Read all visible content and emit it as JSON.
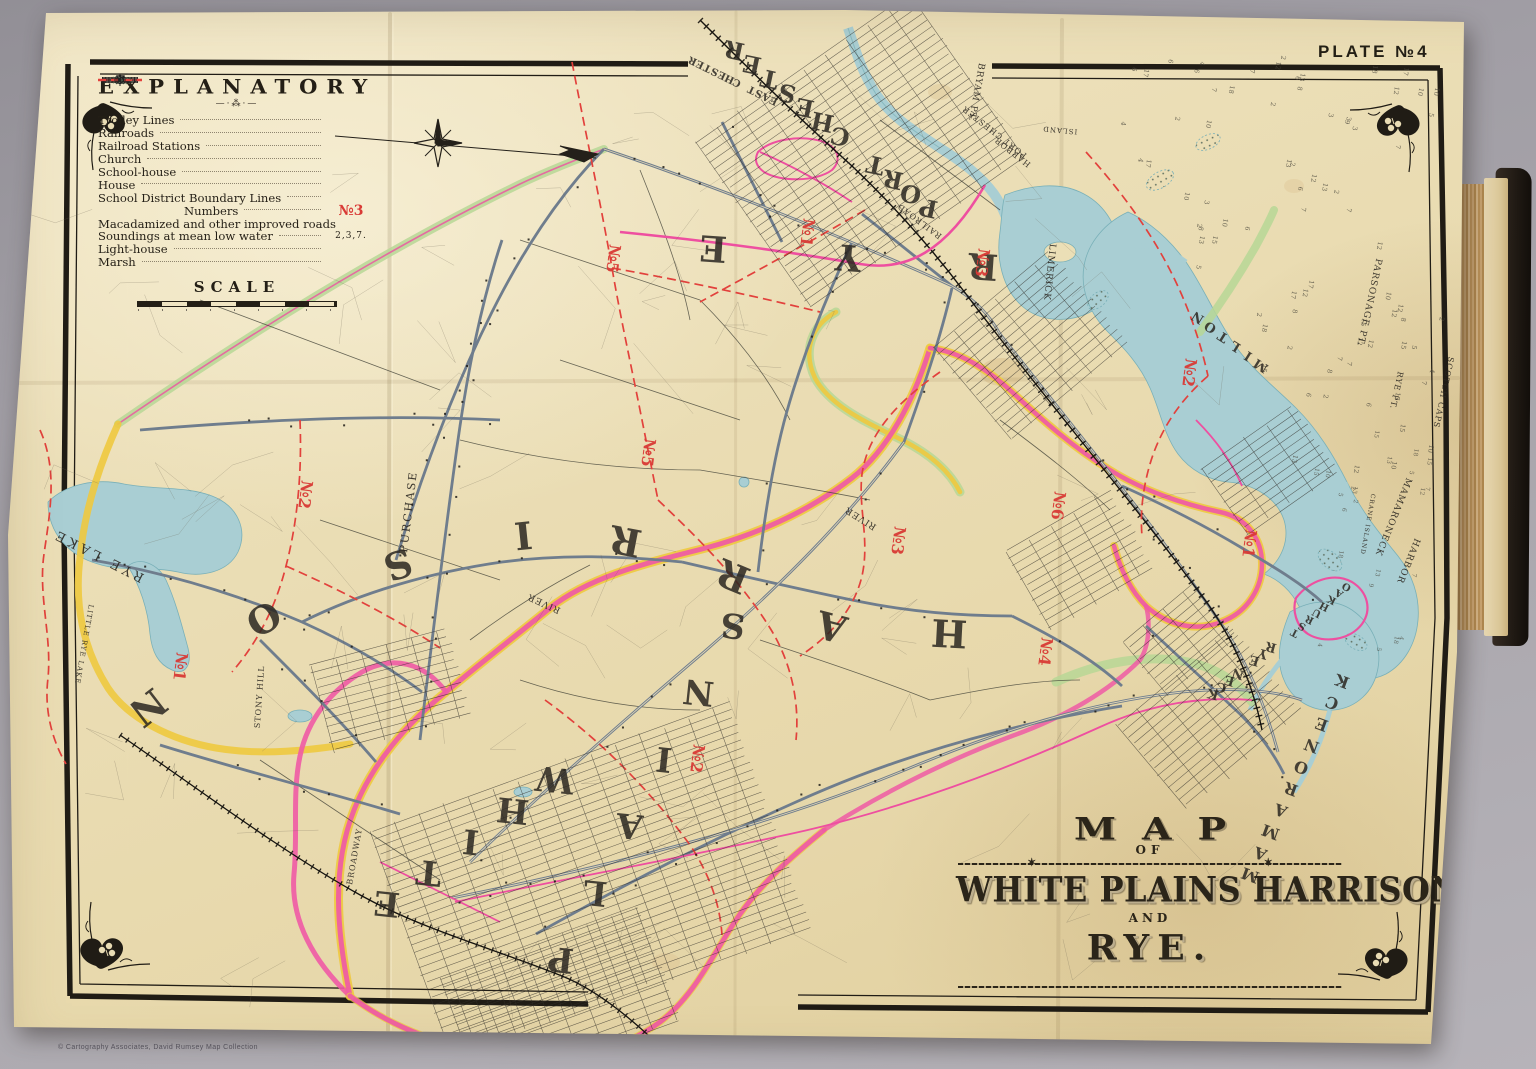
{
  "plate_label": "PLATE №4",
  "credit": "© Cartography Associates, David Rumsey Map Collection",
  "legend": {
    "title": "EXPLANATORY",
    "items": [
      {
        "label": "Trolley Lines",
        "symbol": "trolley-line"
      },
      {
        "label": "Railroads",
        "symbol": "railroad-line"
      },
      {
        "label": "Railroad Stations",
        "symbol": "station-square"
      },
      {
        "label": "Church",
        "symbol": "church-cross"
      },
      {
        "label": "School-house",
        "symbol": "school-rect"
      },
      {
        "label": "House",
        "symbol": "house-dot"
      },
      {
        "label": "School District Boundary Lines",
        "symbol": "red-dashes"
      },
      {
        "label": "Numbers",
        "symbol": "district-number",
        "symbol_text": "№3",
        "indent": true
      },
      {
        "label": "Macadamized and other improved roads",
        "symbol": "macadam-line"
      },
      {
        "label": "Soundings at mean low water",
        "symbol": "soundings-text",
        "symbol_text": "2,3,7."
      },
      {
        "label": "Light-house",
        "symbol": "lighthouse-star"
      },
      {
        "label": "Marsh",
        "symbol": "marsh-glyph"
      }
    ],
    "scale_title": "SCALE"
  },
  "title_cartouche": {
    "line1": "MAP",
    "line2": "OF",
    "line3": "WHITE PLAINS HARRISON",
    "line4": "AND",
    "line5": "RYE."
  },
  "map": {
    "colors": {
      "paper": "#ebdfb6",
      "ink": "#2b2721",
      "water": "#a9ced3",
      "boundary_pink": "#ef5aa5",
      "boundary_yellow": "#eec93f",
      "boundary_green": "#b7d795",
      "district_red": "#d93a35",
      "trolley_pink": "#ee4fa0"
    },
    "towns_large": [
      {
        "text": "RYE",
        "x1": 984,
        "y1": 254,
        "x2": 714,
        "y2": 236,
        "size": 36,
        "rot": 184
      },
      {
        "text": "PORT CHESTER",
        "x1": 930,
        "y1": 200,
        "x2": 736,
        "y2": 42,
        "size": 24,
        "rot": 192
      },
      {
        "text": "EAST CHESTER",
        "x1": 775,
        "y1": 98,
        "x2": 694,
        "y2": 58,
        "size": 10,
        "rot": 205
      },
      {
        "text": "WHITE",
        "x1": 556,
        "y1": 768,
        "x2": 388,
        "y2": 892,
        "size": 34,
        "rot": 186
      },
      {
        "text": "PLAINS",
        "x1": 562,
        "y1": 948,
        "x2": 734,
        "y2": 614,
        "size": 34,
        "rot": 186
      },
      {
        "text": "MAMARONECK",
        "x1": 1252,
        "y1": 870,
        "x2": 1344,
        "y2": 676,
        "size": 16,
        "rot": 200
      },
      {
        "text": "RYE NECK",
        "x1": 1272,
        "y1": 643,
        "x2": 1214,
        "y2": 690,
        "size": 13,
        "rot": 195
      },
      {
        "text": "OAKHURST",
        "x1": 1348,
        "y1": 584,
        "x2": 1296,
        "y2": 630,
        "size": 10,
        "rot": 207
      },
      {
        "text": "MILTON",
        "x1": 1263,
        "y1": 362,
        "x2": 1200,
        "y2": 314,
        "size": 13,
        "rot": 212
      },
      {
        "text": "HARRISON",
        "letters": [
          {
            "c": "H",
            "x": 950,
            "y": 620
          },
          {
            "c": "A",
            "x": 835,
            "y": 614
          },
          {
            "c": "R",
            "x": 738,
            "y": 564
          },
          {
            "c": "R",
            "x": 628,
            "y": 528
          },
          {
            "c": "I",
            "x": 522,
            "y": 522
          },
          {
            "c": "S",
            "x": 394,
            "y": 552
          },
          {
            "c": "O",
            "x": 257,
            "y": 607
          },
          {
            "c": "N",
            "x": 140,
            "y": 697
          }
        ],
        "size": 38
      }
    ],
    "small_labels": [
      {
        "text": "PURCHASE",
        "x": 412,
        "y": 512,
        "rot": -83,
        "size": 11,
        "sp": 2
      },
      {
        "text": "RIVER",
        "x": 545,
        "y": 601,
        "rot": 205,
        "size": 9
      },
      {
        "text": "RIVER",
        "x": 862,
        "y": 516,
        "rot": 212,
        "size": 9
      },
      {
        "text": "BRYAM PT.",
        "x": 974,
        "y": 92,
        "rot": 100,
        "size": 9
      },
      {
        "text": "PORT CHESTER",
        "x": 996,
        "y": 130,
        "rot": 218,
        "size": 8
      },
      {
        "text": "HARBOR",
        "x": 1014,
        "y": 150,
        "rot": 218,
        "size": 8
      },
      {
        "text": "ISLAND",
        "x": 1060,
        "y": 128,
        "rot": 185,
        "size": 7
      },
      {
        "text": "LIMERICK",
        "x": 1047,
        "y": 272,
        "rot": 96,
        "size": 9
      },
      {
        "text": "RAILROAD",
        "x": 921,
        "y": 219,
        "rot": 217,
        "size": 8
      },
      {
        "text": "PARSONAGE PT.",
        "x": 1367,
        "y": 302,
        "rot": 102,
        "size": 9
      },
      {
        "text": "RYE PT.",
        "x": 1394,
        "y": 390,
        "rot": 102,
        "size": 8
      },
      {
        "text": "SCOTCH CAPS",
        "x": 1441,
        "y": 392,
        "rot": 102,
        "size": 8
      },
      {
        "text": "MAMARONECK",
        "x": 1391,
        "y": 516,
        "rot": 112,
        "size": 9
      },
      {
        "text": "HARBOR",
        "x": 1406,
        "y": 560,
        "rot": 112,
        "size": 9
      },
      {
        "text": "CRANE ISLAND",
        "x": 1366,
        "y": 524,
        "rot": 100,
        "size": 6
      },
      {
        "text": "RYE LAKE",
        "x": 100,
        "y": 552,
        "rot": 207,
        "size": 13,
        "sp": 4
      },
      {
        "text": "LITTLE RYE LAKE",
        "x": 82,
        "y": 644,
        "rot": 100,
        "size": 7
      },
      {
        "text": "BROADWAY",
        "x": 357,
        "y": 857,
        "rot": -80,
        "size": 8
      },
      {
        "text": "STONY HILL",
        "x": 262,
        "y": 697,
        "rot": -86,
        "size": 8
      }
    ],
    "district_numbers": [
      {
        "text": "№5",
        "x": 608,
        "y": 258
      },
      {
        "text": "№2",
        "x": 300,
        "y": 494
      },
      {
        "text": "№5",
        "x": 643,
        "y": 452
      },
      {
        "text": "№1",
        "x": 175,
        "y": 666
      },
      {
        "text": "№3",
        "x": 893,
        "y": 540
      },
      {
        "text": "№2",
        "x": 692,
        "y": 758
      },
      {
        "text": "№4",
        "x": 1040,
        "y": 651
      },
      {
        "text": "№6",
        "x": 1053,
        "y": 505
      },
      {
        "text": "№3",
        "x": 977,
        "y": 262
      },
      {
        "text": "№1",
        "x": 1244,
        "y": 543
      },
      {
        "text": "№2",
        "x": 1184,
        "y": 372
      },
      {
        "text": "№1",
        "x": 802,
        "y": 232
      }
    ],
    "soundings_digits": [
      "2",
      "3",
      "4",
      "5",
      "6",
      "7",
      "8",
      "9",
      "10",
      "12",
      "13",
      "15",
      "17",
      "18"
    ]
  }
}
